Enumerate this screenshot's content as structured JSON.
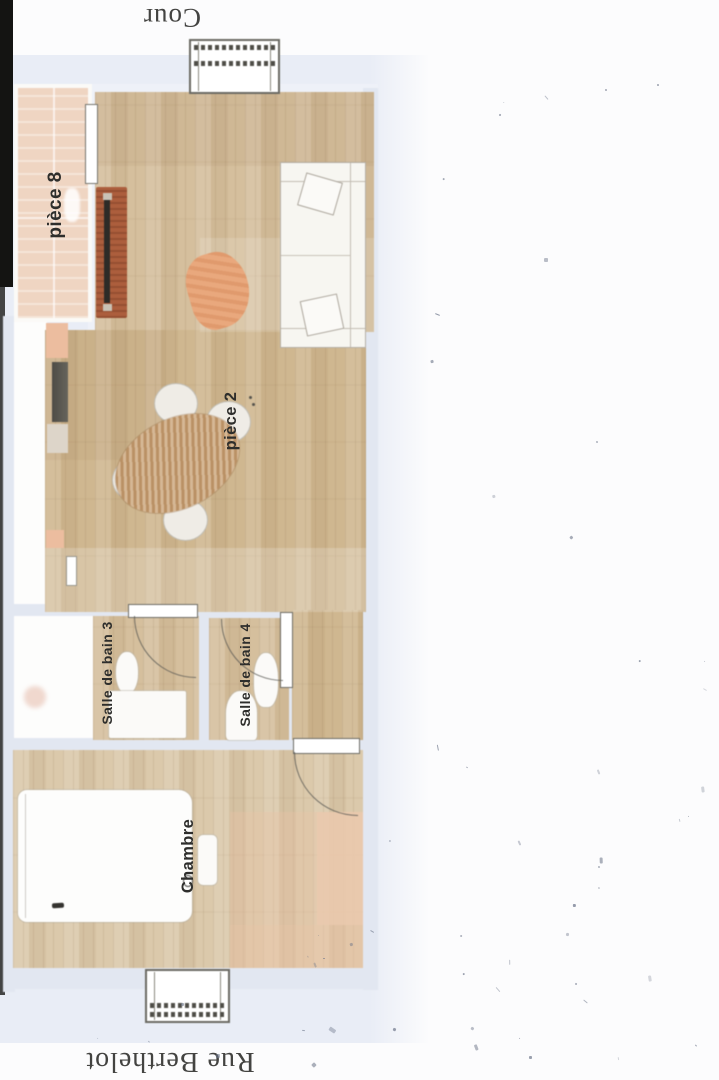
{
  "scan": {
    "kind": "apartment floor plan (scanned)",
    "street_labels": {
      "top": "Cour",
      "bottom": "Rue Berthelot"
    },
    "room_labels": {
      "piece8": "pièce 8",
      "piece2": "pièce 2",
      "bath3": "Salle de bain 3",
      "bath4": "Salle de bain 4",
      "bedroom": "Chambre"
    },
    "furniture": [
      "sofa",
      "sofa-pillow",
      "armchair",
      "dining-table",
      "dining-chair",
      "tv-sideboard",
      "tv",
      "kitchen-counter",
      "cooktop",
      "kitchen-unit",
      "bathtub-area",
      "toilet",
      "washbasin",
      "vanity",
      "bed",
      "bedside-table",
      "rug",
      "radiator-window",
      "door",
      "door-swing"
    ]
  },
  "colors": {
    "page": "#fcfcfd",
    "tint": "#e9edf6",
    "wall": "#e2e7f1",
    "white_room": "#fdfdfc",
    "wood": "#d5bf9d",
    "wood_dark": "#cfb790",
    "wood_bedroom": "#dbc9ab",
    "balcony": "#efd5c2",
    "furniture_white": "#f7f6f1",
    "outline": "#6e6d66",
    "sideboard_red": "#ac5e3d",
    "tv_black": "#2d2b27",
    "armchair": "#e9a87d",
    "table": "#c79f72",
    "rug_pink": "#eac9ad",
    "label_ink": "#2e2e2c",
    "street_ink": "#434341",
    "scan_edge": "#141412",
    "speckle": "#6b7488"
  }
}
